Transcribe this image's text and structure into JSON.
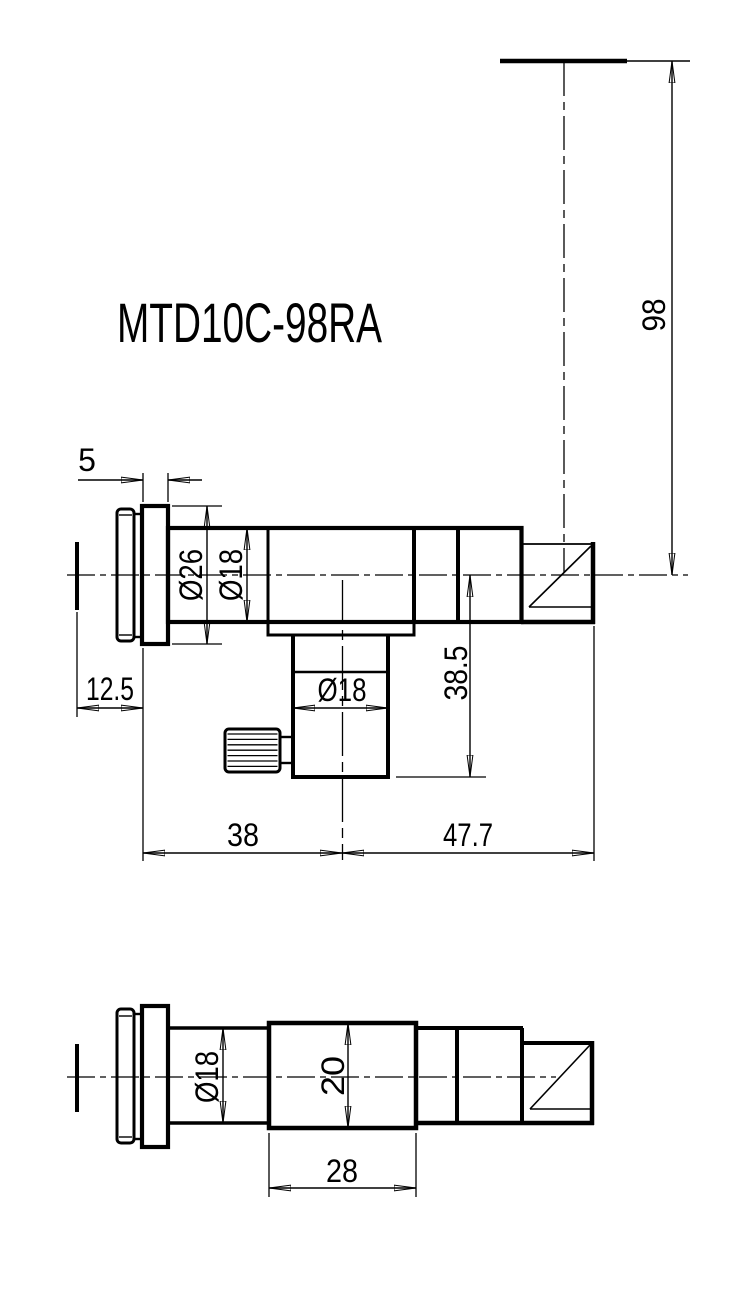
{
  "page": {
    "background": "#ffffff",
    "ink": "#000000"
  },
  "title": "MTD10C-98RA",
  "views": {
    "side": {
      "label": "side-view",
      "dims": {
        "flange_thickness": "5",
        "face_offset": "12.5",
        "flange_od": "Ø26",
        "barrel_od": "Ø18",
        "drop_tube_od": "Ø18",
        "axis_height": "98",
        "axis_to_base": "38.5",
        "face_to_drop_axis": "38",
        "drop_axis_to_rear": "47.7"
      }
    },
    "top": {
      "label": "top-view",
      "dims": {
        "barrel_od": "Ø18",
        "block_height": "20",
        "block_length": "28"
      }
    }
  }
}
